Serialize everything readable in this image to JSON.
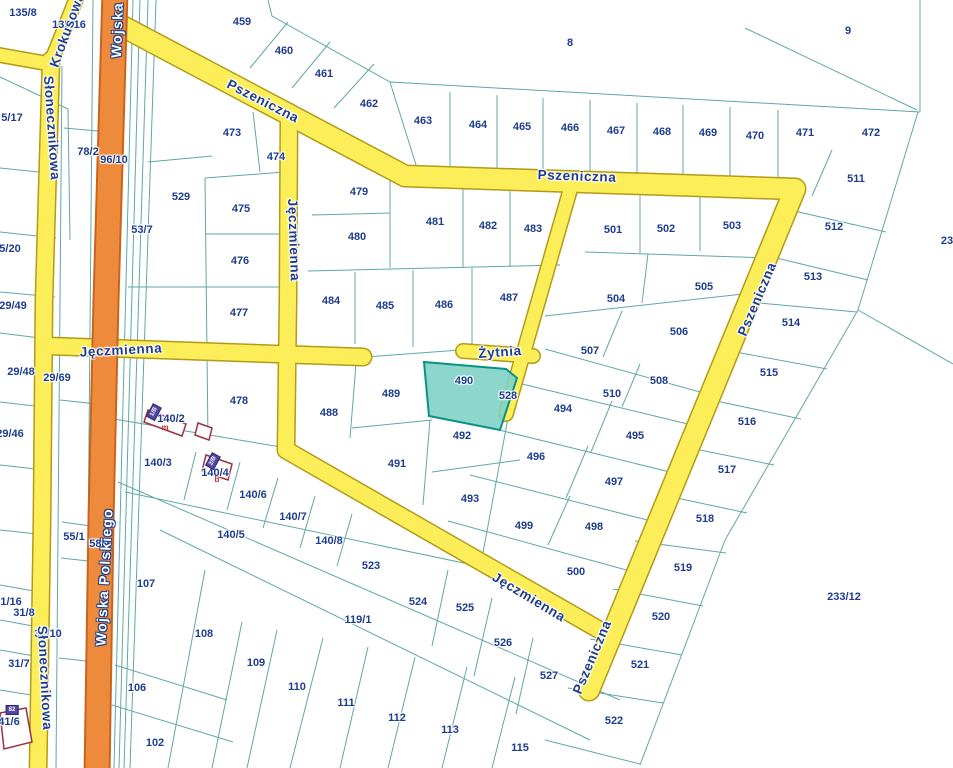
{
  "map": {
    "selected_parcel": "490",
    "colors": {
      "background": "#ffffff",
      "parcel_boundary": "#5fa8a6",
      "parcel_label": "#1e3d8f",
      "road_fill": "#fcee58",
      "road_border": "#b49a18",
      "highway_fill": "#ee8a3c",
      "highway_border": "#c9641c",
      "highlight_fill": "#7fd2c6",
      "highlight_border": "#0a9185",
      "building_outline": "#9e2f42",
      "building_tag_fill": "#4f46a8"
    },
    "parcel_labels": [
      {
        "t": "135/8",
        "x": 23,
        "y": 13
      },
      {
        "t": "135/16",
        "x": 69,
        "y": 25
      },
      {
        "t": "5/17",
        "x": 12,
        "y": 118
      },
      {
        "t": "78/2",
        "x": 88,
        "y": 152
      },
      {
        "t": "96/10",
        "x": 114,
        "y": 160
      },
      {
        "t": "53/7",
        "x": 142,
        "y": 230
      },
      {
        "t": "5/20",
        "x": 10,
        "y": 249
      },
      {
        "t": "29/49",
        "x": 13,
        "y": 306
      },
      {
        "t": "29/48",
        "x": 21,
        "y": 372
      },
      {
        "t": "29/69",
        "x": 57,
        "y": 378
      },
      {
        "t": "29/46",
        "x": 10,
        "y": 434
      },
      {
        "t": "55/1",
        "x": 74,
        "y": 537
      },
      {
        "t": "58/1",
        "x": 100,
        "y": 544
      },
      {
        "t": "31/16",
        "x": 8,
        "y": 602
      },
      {
        "t": "31/8",
        "x": 24,
        "y": 613
      },
      {
        "t": "31/10",
        "x": 48,
        "y": 634
      },
      {
        "t": "31/7",
        "x": 19,
        "y": 664
      },
      {
        "t": "41/6",
        "x": 9,
        "y": 722
      },
      {
        "t": "106",
        "x": 137,
        "y": 688
      },
      {
        "t": "102",
        "x": 155,
        "y": 743
      },
      {
        "t": "107",
        "x": 146,
        "y": 584
      },
      {
        "t": "108",
        "x": 204,
        "y": 634
      },
      {
        "t": "109",
        "x": 256,
        "y": 663
      },
      {
        "t": "110",
        "x": 297,
        "y": 687
      },
      {
        "t": "111",
        "x": 346,
        "y": 703
      },
      {
        "t": "112",
        "x": 397,
        "y": 718
      },
      {
        "t": "113",
        "x": 450,
        "y": 730
      },
      {
        "t": "115",
        "x": 520,
        "y": 748
      },
      {
        "t": "119/1",
        "x": 358,
        "y": 620
      },
      {
        "t": "140/2",
        "x": 171,
        "y": 419
      },
      {
        "t": "140/3",
        "x": 158,
        "y": 463
      },
      {
        "t": "140/4",
        "x": 215,
        "y": 473
      },
      {
        "t": "140/5",
        "x": 231,
        "y": 535
      },
      {
        "t": "140/6",
        "x": 253,
        "y": 495
      },
      {
        "t": "140/7",
        "x": 293,
        "y": 517
      },
      {
        "t": "140/8",
        "x": 329,
        "y": 541
      },
      {
        "t": "523",
        "x": 371,
        "y": 566
      },
      {
        "t": "459",
        "x": 242,
        "y": 22
      },
      {
        "t": "460",
        "x": 284,
        "y": 51
      },
      {
        "t": "461",
        "x": 324,
        "y": 74
      },
      {
        "t": "462",
        "x": 369,
        "y": 104
      },
      {
        "t": "463",
        "x": 423,
        "y": 121
      },
      {
        "t": "464",
        "x": 478,
        "y": 125
      },
      {
        "t": "465",
        "x": 522,
        "y": 127
      },
      {
        "t": "466",
        "x": 570,
        "y": 128
      },
      {
        "t": "467",
        "x": 616,
        "y": 131
      },
      {
        "t": "468",
        "x": 662,
        "y": 132
      },
      {
        "t": "469",
        "x": 708,
        "y": 133
      },
      {
        "t": "470",
        "x": 755,
        "y": 136
      },
      {
        "t": "471",
        "x": 805,
        "y": 133
      },
      {
        "t": "472",
        "x": 871,
        "y": 133
      },
      {
        "t": "8",
        "x": 570,
        "y": 43
      },
      {
        "t": "9",
        "x": 848,
        "y": 31
      },
      {
        "t": "473",
        "x": 232,
        "y": 133
      },
      {
        "t": "474",
        "x": 276,
        "y": 157
      },
      {
        "t": "529",
        "x": 181,
        "y": 197
      },
      {
        "t": "475",
        "x": 241,
        "y": 209
      },
      {
        "t": "476",
        "x": 240,
        "y": 261
      },
      {
        "t": "477",
        "x": 239,
        "y": 313
      },
      {
        "t": "478",
        "x": 239,
        "y": 401
      },
      {
        "t": "479",
        "x": 359,
        "y": 192
      },
      {
        "t": "480",
        "x": 357,
        "y": 237
      },
      {
        "t": "481",
        "x": 435,
        "y": 222
      },
      {
        "t": "482",
        "x": 488,
        "y": 226
      },
      {
        "t": "483",
        "x": 533,
        "y": 229
      },
      {
        "t": "484",
        "x": 331,
        "y": 301
      },
      {
        "t": "485",
        "x": 385,
        "y": 306
      },
      {
        "t": "486",
        "x": 444,
        "y": 305
      },
      {
        "t": "487",
        "x": 509,
        "y": 298
      },
      {
        "t": "488",
        "x": 329,
        "y": 413
      },
      {
        "t": "489",
        "x": 391,
        "y": 394
      },
      {
        "t": "490",
        "x": 464,
        "y": 381
      },
      {
        "t": "528",
        "x": 508,
        "y": 396
      },
      {
        "t": "491",
        "x": 397,
        "y": 464
      },
      {
        "t": "492",
        "x": 462,
        "y": 436
      },
      {
        "t": "493",
        "x": 470,
        "y": 499
      },
      {
        "t": "494",
        "x": 563,
        "y": 409
      },
      {
        "t": "495",
        "x": 635,
        "y": 436
      },
      {
        "t": "496",
        "x": 536,
        "y": 457
      },
      {
        "t": "497",
        "x": 614,
        "y": 482
      },
      {
        "t": "498",
        "x": 594,
        "y": 527
      },
      {
        "t": "499",
        "x": 524,
        "y": 526
      },
      {
        "t": "500",
        "x": 576,
        "y": 572
      },
      {
        "t": "501",
        "x": 613,
        "y": 230
      },
      {
        "t": "502",
        "x": 666,
        "y": 229
      },
      {
        "t": "503",
        "x": 732,
        "y": 226
      },
      {
        "t": "504",
        "x": 616,
        "y": 299
      },
      {
        "t": "505",
        "x": 704,
        "y": 287
      },
      {
        "t": "506",
        "x": 679,
        "y": 332
      },
      {
        "t": "507",
        "x": 590,
        "y": 351
      },
      {
        "t": "508",
        "x": 659,
        "y": 381
      },
      {
        "t": "510",
        "x": 612,
        "y": 394
      },
      {
        "t": "511",
        "x": 856,
        "y": 179
      },
      {
        "t": "512",
        "x": 834,
        "y": 227
      },
      {
        "t": "513",
        "x": 813,
        "y": 277
      },
      {
        "t": "514",
        "x": 791,
        "y": 323
      },
      {
        "t": "515",
        "x": 769,
        "y": 373
      },
      {
        "t": "516",
        "x": 747,
        "y": 422
      },
      {
        "t": "517",
        "x": 727,
        "y": 470
      },
      {
        "t": "518",
        "x": 705,
        "y": 519
      },
      {
        "t": "519",
        "x": 683,
        "y": 568
      },
      {
        "t": "520",
        "x": 661,
        "y": 617
      },
      {
        "t": "521",
        "x": 640,
        "y": 665
      },
      {
        "t": "522",
        "x": 614,
        "y": 721
      },
      {
        "t": "524",
        "x": 418,
        "y": 602
      },
      {
        "t": "525",
        "x": 465,
        "y": 608
      },
      {
        "t": "526",
        "x": 503,
        "y": 643
      },
      {
        "t": "527",
        "x": 549,
        "y": 676
      },
      {
        "t": "233/12",
        "x": 844,
        "y": 597
      },
      {
        "t": "23",
        "x": 947,
        "y": 241
      }
    ],
    "street_labels": [
      {
        "t": "Krokusowa",
        "x": 67,
        "y": 30,
        "rot": -70,
        "variant": "yellow"
      },
      {
        "t": "Wojska",
        "x": 117,
        "y": 30,
        "rot": -88,
        "variant": "orange"
      },
      {
        "t": "Słonecznikowa",
        "x": 52,
        "y": 128,
        "rot": 86,
        "variant": "yellow"
      },
      {
        "t": "Pszeniczna",
        "x": 263,
        "y": 101,
        "rot": 27,
        "variant": "yellow"
      },
      {
        "t": "Pszeniczna",
        "x": 577,
        "y": 176,
        "rot": 2,
        "variant": "yellow"
      },
      {
        "t": "Pszeniczna",
        "x": 757,
        "y": 299,
        "rot": -67,
        "variant": "yellow"
      },
      {
        "t": "Pszeniczna",
        "x": 592,
        "y": 657,
        "rot": -67,
        "variant": "yellow"
      },
      {
        "t": "Jęczmienna",
        "x": 294,
        "y": 240,
        "rot": 88,
        "variant": "yellow"
      },
      {
        "t": "Jęczmienna",
        "x": 121,
        "y": 350,
        "rot": -3,
        "variant": "yellow"
      },
      {
        "t": "Jęczmienna",
        "x": 529,
        "y": 597,
        "rot": 31,
        "variant": "yellow"
      },
      {
        "t": "Żytnia",
        "x": 500,
        "y": 352,
        "rot": -4,
        "variant": "yellow"
      },
      {
        "t": "Wojska Polskiego",
        "x": 104,
        "y": 577,
        "rot": -87,
        "variant": "orange"
      },
      {
        "t": "Słonecznikowa",
        "x": 45,
        "y": 678,
        "rot": 87,
        "variant": "yellow"
      }
    ],
    "building_tags": [
      {
        "t": "1/B",
        "x": 154,
        "y": 412,
        "rot": -62
      },
      {
        "t": "2/B",
        "x": 213,
        "y": 461,
        "rot": -62
      },
      {
        "t": "82",
        "x": 12,
        "y": 710,
        "rot": 0
      }
    ],
    "building_marks": [
      {
        "t": "m",
        "x": 165,
        "y": 428
      },
      {
        "t": "b",
        "x": 217,
        "y": 480
      }
    ]
  }
}
